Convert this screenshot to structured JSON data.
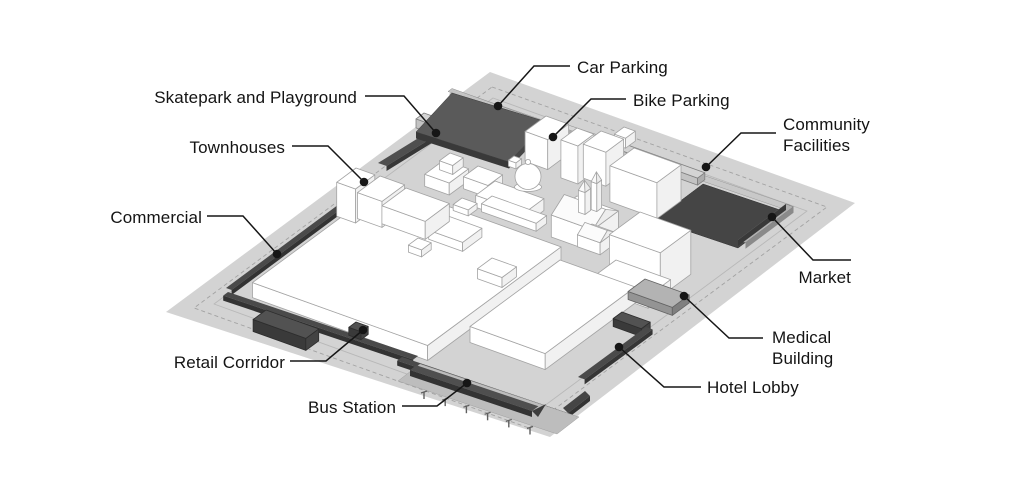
{
  "diagram": {
    "type": "isometric-site-plan",
    "background": "#ffffff",
    "palette": {
      "ground": "#d3d3d3",
      "dark_program": "#4a4a4a",
      "building_white": "#ffffff",
      "outline_gray": "#a3a3a3",
      "platform_gray": "#bdbdbd",
      "label_text": "#141414",
      "leader_line": "#161616"
    },
    "callouts": {
      "car_parking": "Car Parking",
      "bike_parking": "Bike Parking",
      "skatepark_playground": "Skatepark and Playground",
      "townhouses": "Townhouses",
      "community_facilities": "Community Facilities",
      "commercial": "Commercial",
      "market": "Market",
      "medical_building": "Medical Building",
      "hotel_lobby": "Hotel Lobby",
      "retail_corridor": "Retail Corridor",
      "bus_station": "Bus Station"
    }
  }
}
